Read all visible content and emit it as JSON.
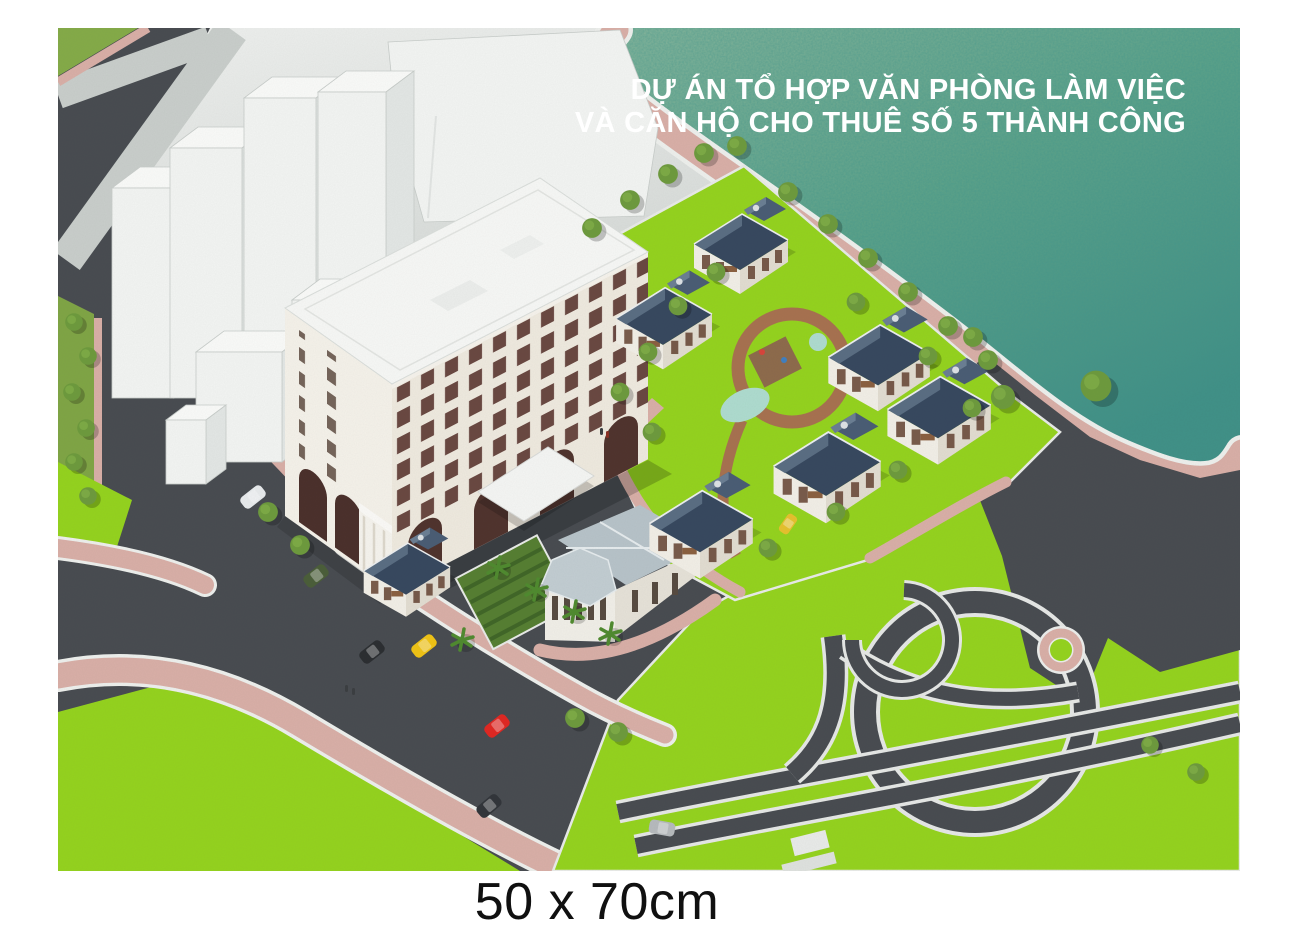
{
  "poster": {
    "title_line1": "DỰ ÁN TỔ HỢP VĂN PHÒNG LÀM VIỆC",
    "title_line2": "VÀ CĂN HỘ CHO THUÊ SỐ 5 THÀNH CÔNG",
    "caption": "50 x 70cm"
  },
  "colors": {
    "page-bg": "#ffffff",
    "title-text": "#ffffff",
    "caption-text": "#101010",
    "water-light": "#8ab89d",
    "water-mid": "#5ea489",
    "water-deep": "#3f8f85",
    "shore-pink": "#d9afa7",
    "road": "#474b50",
    "context-gray": "#cdd2cf",
    "context-light": "#eef0ee",
    "road-light": "#c9cecb",
    "lawn": "#94d31d",
    "lawn-olive": "#7fa544",
    "massing-white": "#f3f5f3",
    "office-wall": "#efeadf",
    "office-wall-end": "#f5f2ea",
    "office-roof": "#f7f8f6",
    "window": "#5d3a33",
    "villa-roof": "#36475e",
    "villa-roof-light": "#5d7186",
    "villa-wall": "#f2efe7",
    "pavilion-roof": "#b7c3c9",
    "garden-path": "#a7714f",
    "tree": "#6d9a3c",
    "tree-light": "#7fae46",
    "palm": "#4f8a2e",
    "taxi": "#f0c314",
    "car-red": "#e02621"
  }
}
